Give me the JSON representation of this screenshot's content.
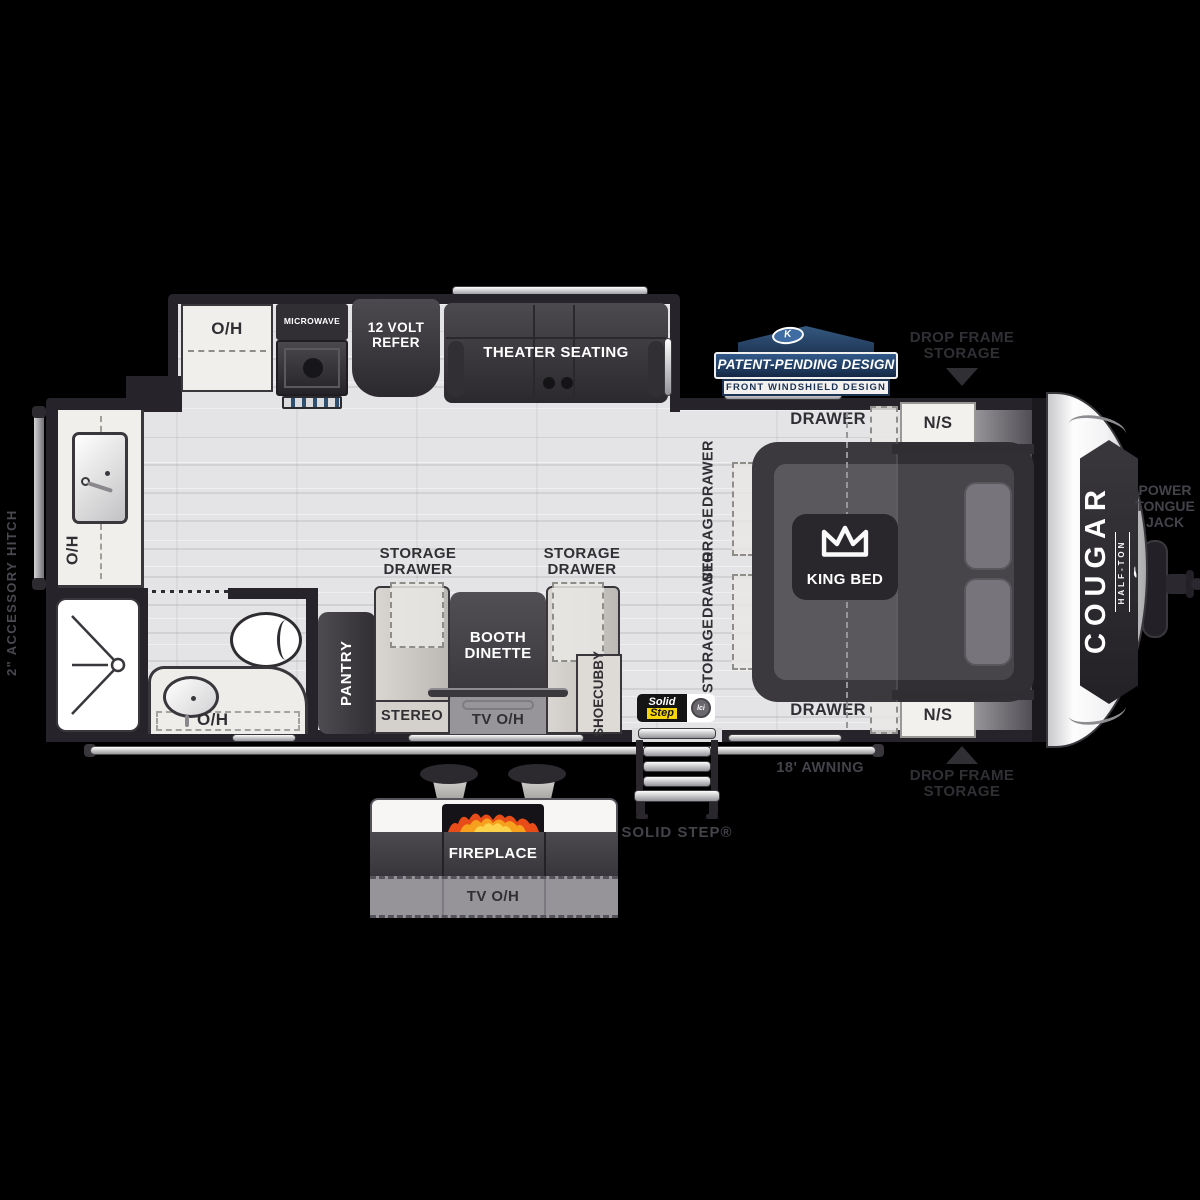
{
  "labels": {
    "slideout": {
      "oh": "O/H",
      "microwave": "MICROWAVE",
      "refer_l1": "12 VOLT",
      "refer_l2": "REFER",
      "theater": "THEATER SEATING"
    },
    "badge": {
      "k": "K",
      "main": "PATENT-PENDING DESIGN",
      "sub": "FRONT WINDSHIELD DESIGN"
    },
    "drop_frame_top": {
      "l1": "DROP FRAME",
      "l2": "STORAGE"
    },
    "drop_frame_bottom": {
      "l1": "DROP FRAME",
      "l2": "STORAGE"
    },
    "power_jack": {
      "l1": "POWER",
      "l2": "TONGUE",
      "l3": "JACK"
    },
    "accessory_hitch": "2\" ACCESSORY HITCH",
    "galley": {
      "oh": "O/H"
    },
    "bath": {
      "oh": "O/H"
    },
    "pantry": "PANTRY",
    "dinette": {
      "storage_left_l1": "STORAGE",
      "storage_left_l2": "DRAWER",
      "storage_right_l1": "STORAGE",
      "storage_right_l2": "DRAWER",
      "booth_l1": "BOOTH",
      "booth_l2": "DINETTE",
      "stereo": "STEREO",
      "tv_oh": "TV O/H",
      "shoe_l1": "SHOE",
      "shoe_l2": "CUBBY"
    },
    "bedroom": {
      "drawer_top": "DRAWER",
      "ns_top": "N/S",
      "drawer_bottom": "DRAWER",
      "ns_bottom": "N/S",
      "storage1_l1": "STORAGE",
      "storage1_l2": "DRAWER",
      "storage2_l1": "STORAGE",
      "storage2_l2": "DRAWER",
      "king": "KING BED"
    },
    "front_cap": {
      "brand": "COUGAR",
      "sub": "HALF-TON"
    },
    "awning": "18' AWNING",
    "solid_step": "SOLID STEP®",
    "solid_badge": {
      "l1": "Solid",
      "l2": "Step",
      "lci": "lci"
    },
    "exterior": {
      "fireplace": "FIREPLACE",
      "tv_oh": "TV O/H"
    }
  },
  "colors": {
    "background": "#000000",
    "floor": "#e4e4e6",
    "wall": "#26242a",
    "furniture_dark": "#3a383c",
    "counter_light": "#f1efec",
    "badge_navy": "#1d3354",
    "badge_blue": "#3f6da3",
    "step_yellow": "#f6d60a",
    "flame_orange": "#e84c18",
    "label_dark": "#302f33",
    "white": "#ffffff"
  }
}
